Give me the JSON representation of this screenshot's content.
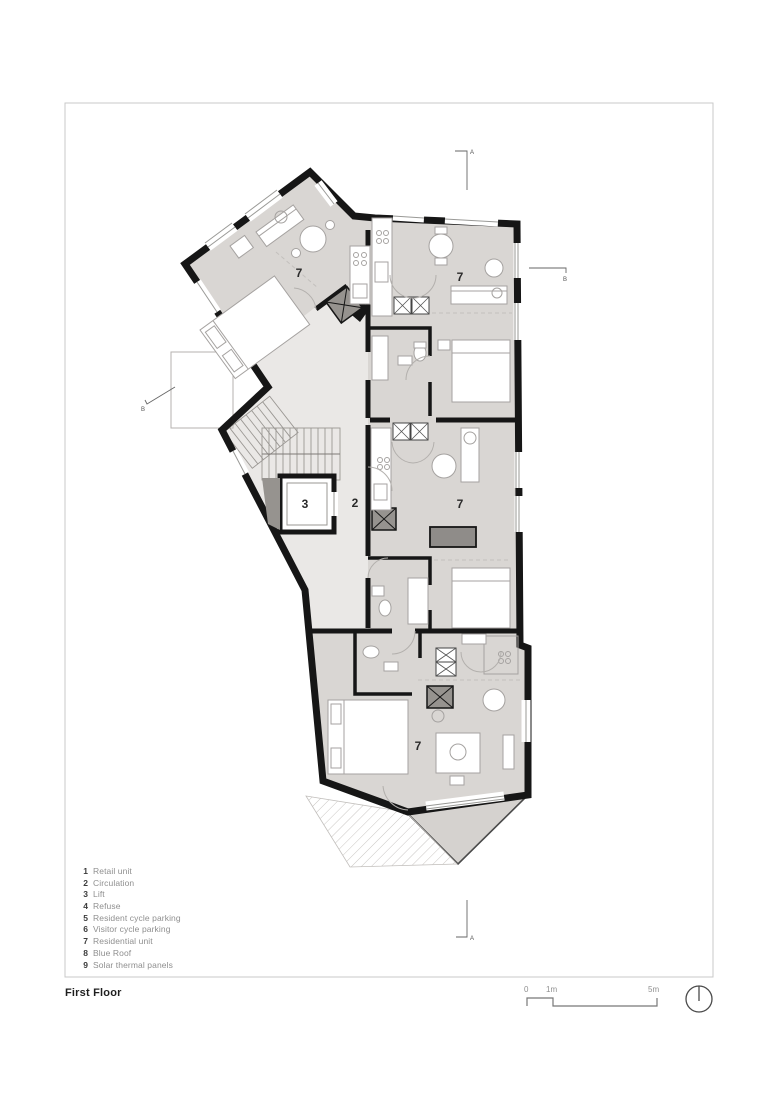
{
  "page": {
    "title": "First Floor"
  },
  "legend": {
    "items": [
      {
        "num": "1",
        "label": "Retail unit"
      },
      {
        "num": "2",
        "label": "Circulation"
      },
      {
        "num": "3",
        "label": "Lift"
      },
      {
        "num": "4",
        "label": "Refuse"
      },
      {
        "num": "5",
        "label": "Resident cycle parking"
      },
      {
        "num": "6",
        "label": "Visitor cycle parking"
      },
      {
        "num": "7",
        "label": "Residential unit"
      },
      {
        "num": "8",
        "label": "Blue Roof"
      },
      {
        "num": "9",
        "label": "Solar thermal panels"
      }
    ]
  },
  "plan": {
    "room_labels": [
      {
        "id": "residential-unit-northwest",
        "text": "7"
      },
      {
        "id": "residential-unit-northeast",
        "text": "7"
      },
      {
        "id": "lift",
        "text": "3"
      },
      {
        "id": "circulation",
        "text": "2"
      },
      {
        "id": "residential-unit-middle",
        "text": "7"
      },
      {
        "id": "residential-unit-south",
        "text": "7"
      }
    ]
  },
  "section_markers": {
    "top": "A",
    "bottom": "A",
    "right": "B",
    "left": "B"
  },
  "scale_bar": {
    "zero": "0",
    "one": "1m",
    "five": "5m"
  },
  "colors": {
    "wall": "#161616",
    "room_fill": "#d9d6d3",
    "circulation_fill": "#eae8e6",
    "terrace_fill": "#d5d2cf",
    "furniture_outline": "#a5a2a0",
    "text_gray": "#8f8f8f"
  }
}
